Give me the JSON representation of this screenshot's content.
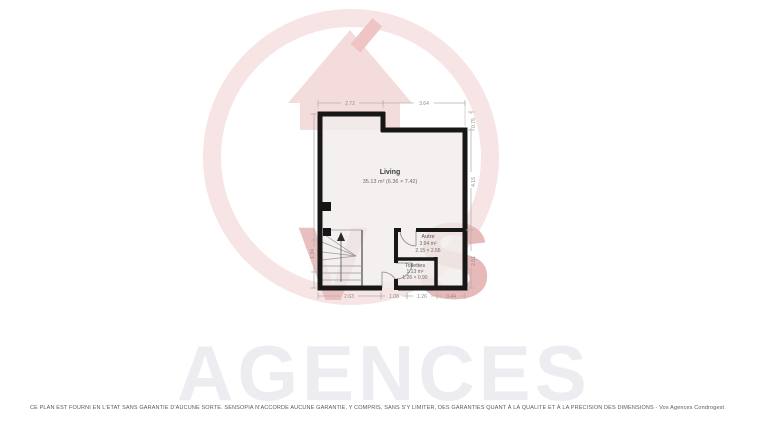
{
  "watermark": {
    "brand_text": "AGENCES",
    "letter_v": "V",
    "letter_s": "s",
    "colors": {
      "circle_pink": "#f7e4e4",
      "house_pink": "#f5dcdc",
      "letters_pink": "#eabfbf",
      "brand_gray": "#ededf1"
    }
  },
  "floorplan": {
    "rooms": {
      "living": {
        "name": "Living",
        "area_line": "35.13 m² (6.36 × 7.42)"
      },
      "autre": {
        "name": "Autre",
        "area": "3.94 m²",
        "size": "2.15 × 2.56"
      },
      "toilettes": {
        "name": "Toilettes",
        "area": "1.13 m²",
        "size": "1.26 × 0.90"
      }
    },
    "dimensions": {
      "top": [
        "2.72",
        "3.64"
      ],
      "bottom": [
        "2.63",
        "1.08",
        "1.26",
        "0.44"
      ],
      "left": [
        "1.34"
      ],
      "right": [
        "0.75",
        "4.15",
        "2.51"
      ]
    },
    "colors": {
      "wall": "#171717",
      "floor": "#f0edeb",
      "dimension_text": "#8f8c8a"
    }
  },
  "footer": {
    "disclaimer": "CE PLAN EST FOURNI EN L'ETAT SANS GARANTIE D'AUCUNE SORTE. SENSOPIA N'ACCORDE AUCUNE GARANTIE, Y COMPRIS, SANS S'Y LIMITER, DES GARANTIES QUANT À LA QUALITE ET À LA PRÉCISION DES DIMENSIONS - Vos Agences Condrogest"
  }
}
